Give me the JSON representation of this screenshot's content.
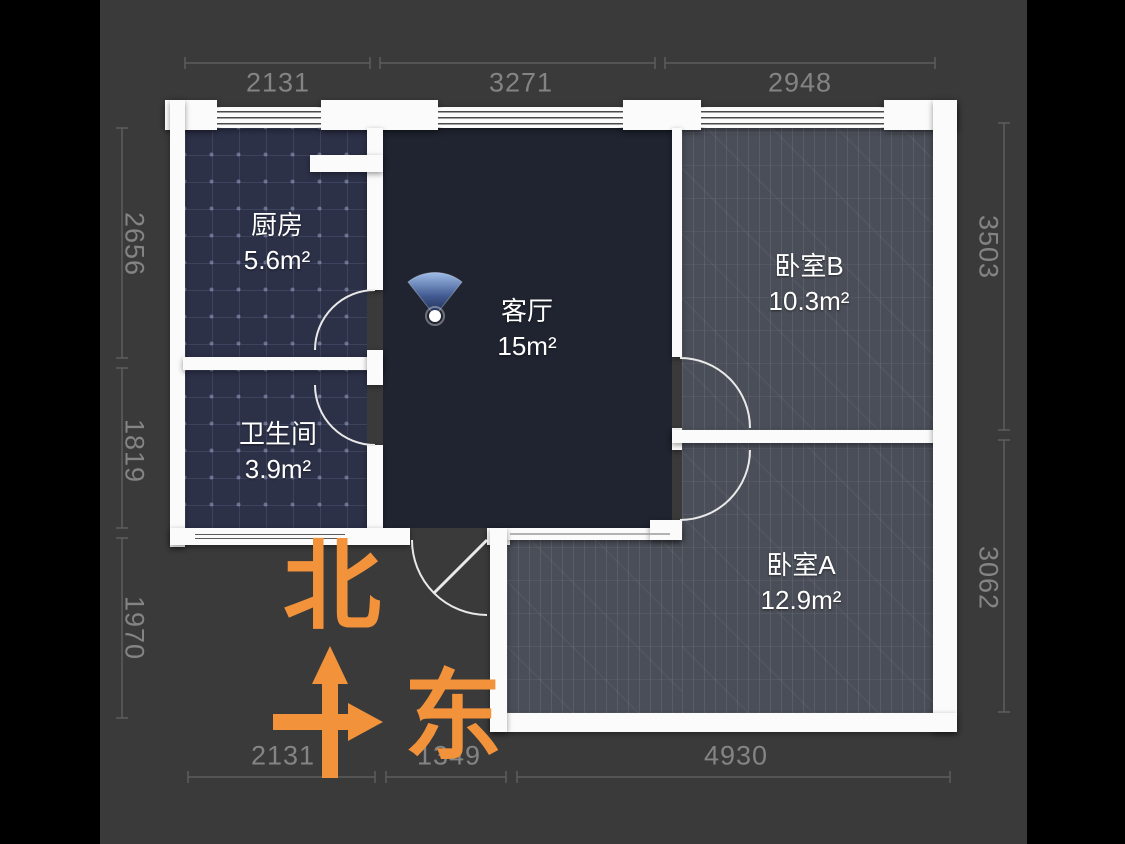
{
  "view": {
    "type": "floor-plan",
    "orientation": {
      "north_label": "北",
      "east_label": "东"
    }
  },
  "rooms": [
    {
      "id": "kitchen",
      "name": "厨房",
      "area": "5.6m²"
    },
    {
      "id": "bathroom",
      "name": "卫生间",
      "area": "3.9m²"
    },
    {
      "id": "living",
      "name": "客厅",
      "area": "15m²"
    },
    {
      "id": "bedroom_b",
      "name": "卧室B",
      "area": "10.3m²"
    },
    {
      "id": "bedroom_a",
      "name": "卧室A",
      "area": "12.9m²"
    }
  ],
  "dimensions_mm": {
    "top": [
      "2131",
      "3271",
      "2948"
    ],
    "left": [
      "2656",
      "1819",
      "1970"
    ],
    "right": [
      "3503",
      "3062"
    ],
    "bottom": [
      "2131",
      "1349",
      "4930"
    ]
  },
  "icons": [
    {
      "name": "camera-viewpoint-icon"
    }
  ],
  "colors": {
    "accent_orange": "#F2923B",
    "canvas_bg": "#3A3A3A",
    "page_bg": "#000000",
    "wall": "#FBFBFB",
    "tile_floor": "#2D3148",
    "living_floor": "#1F2430",
    "wood_floor": "#4A4E58",
    "dim_text": "#848484",
    "camera_blue": "#6E93CC"
  }
}
